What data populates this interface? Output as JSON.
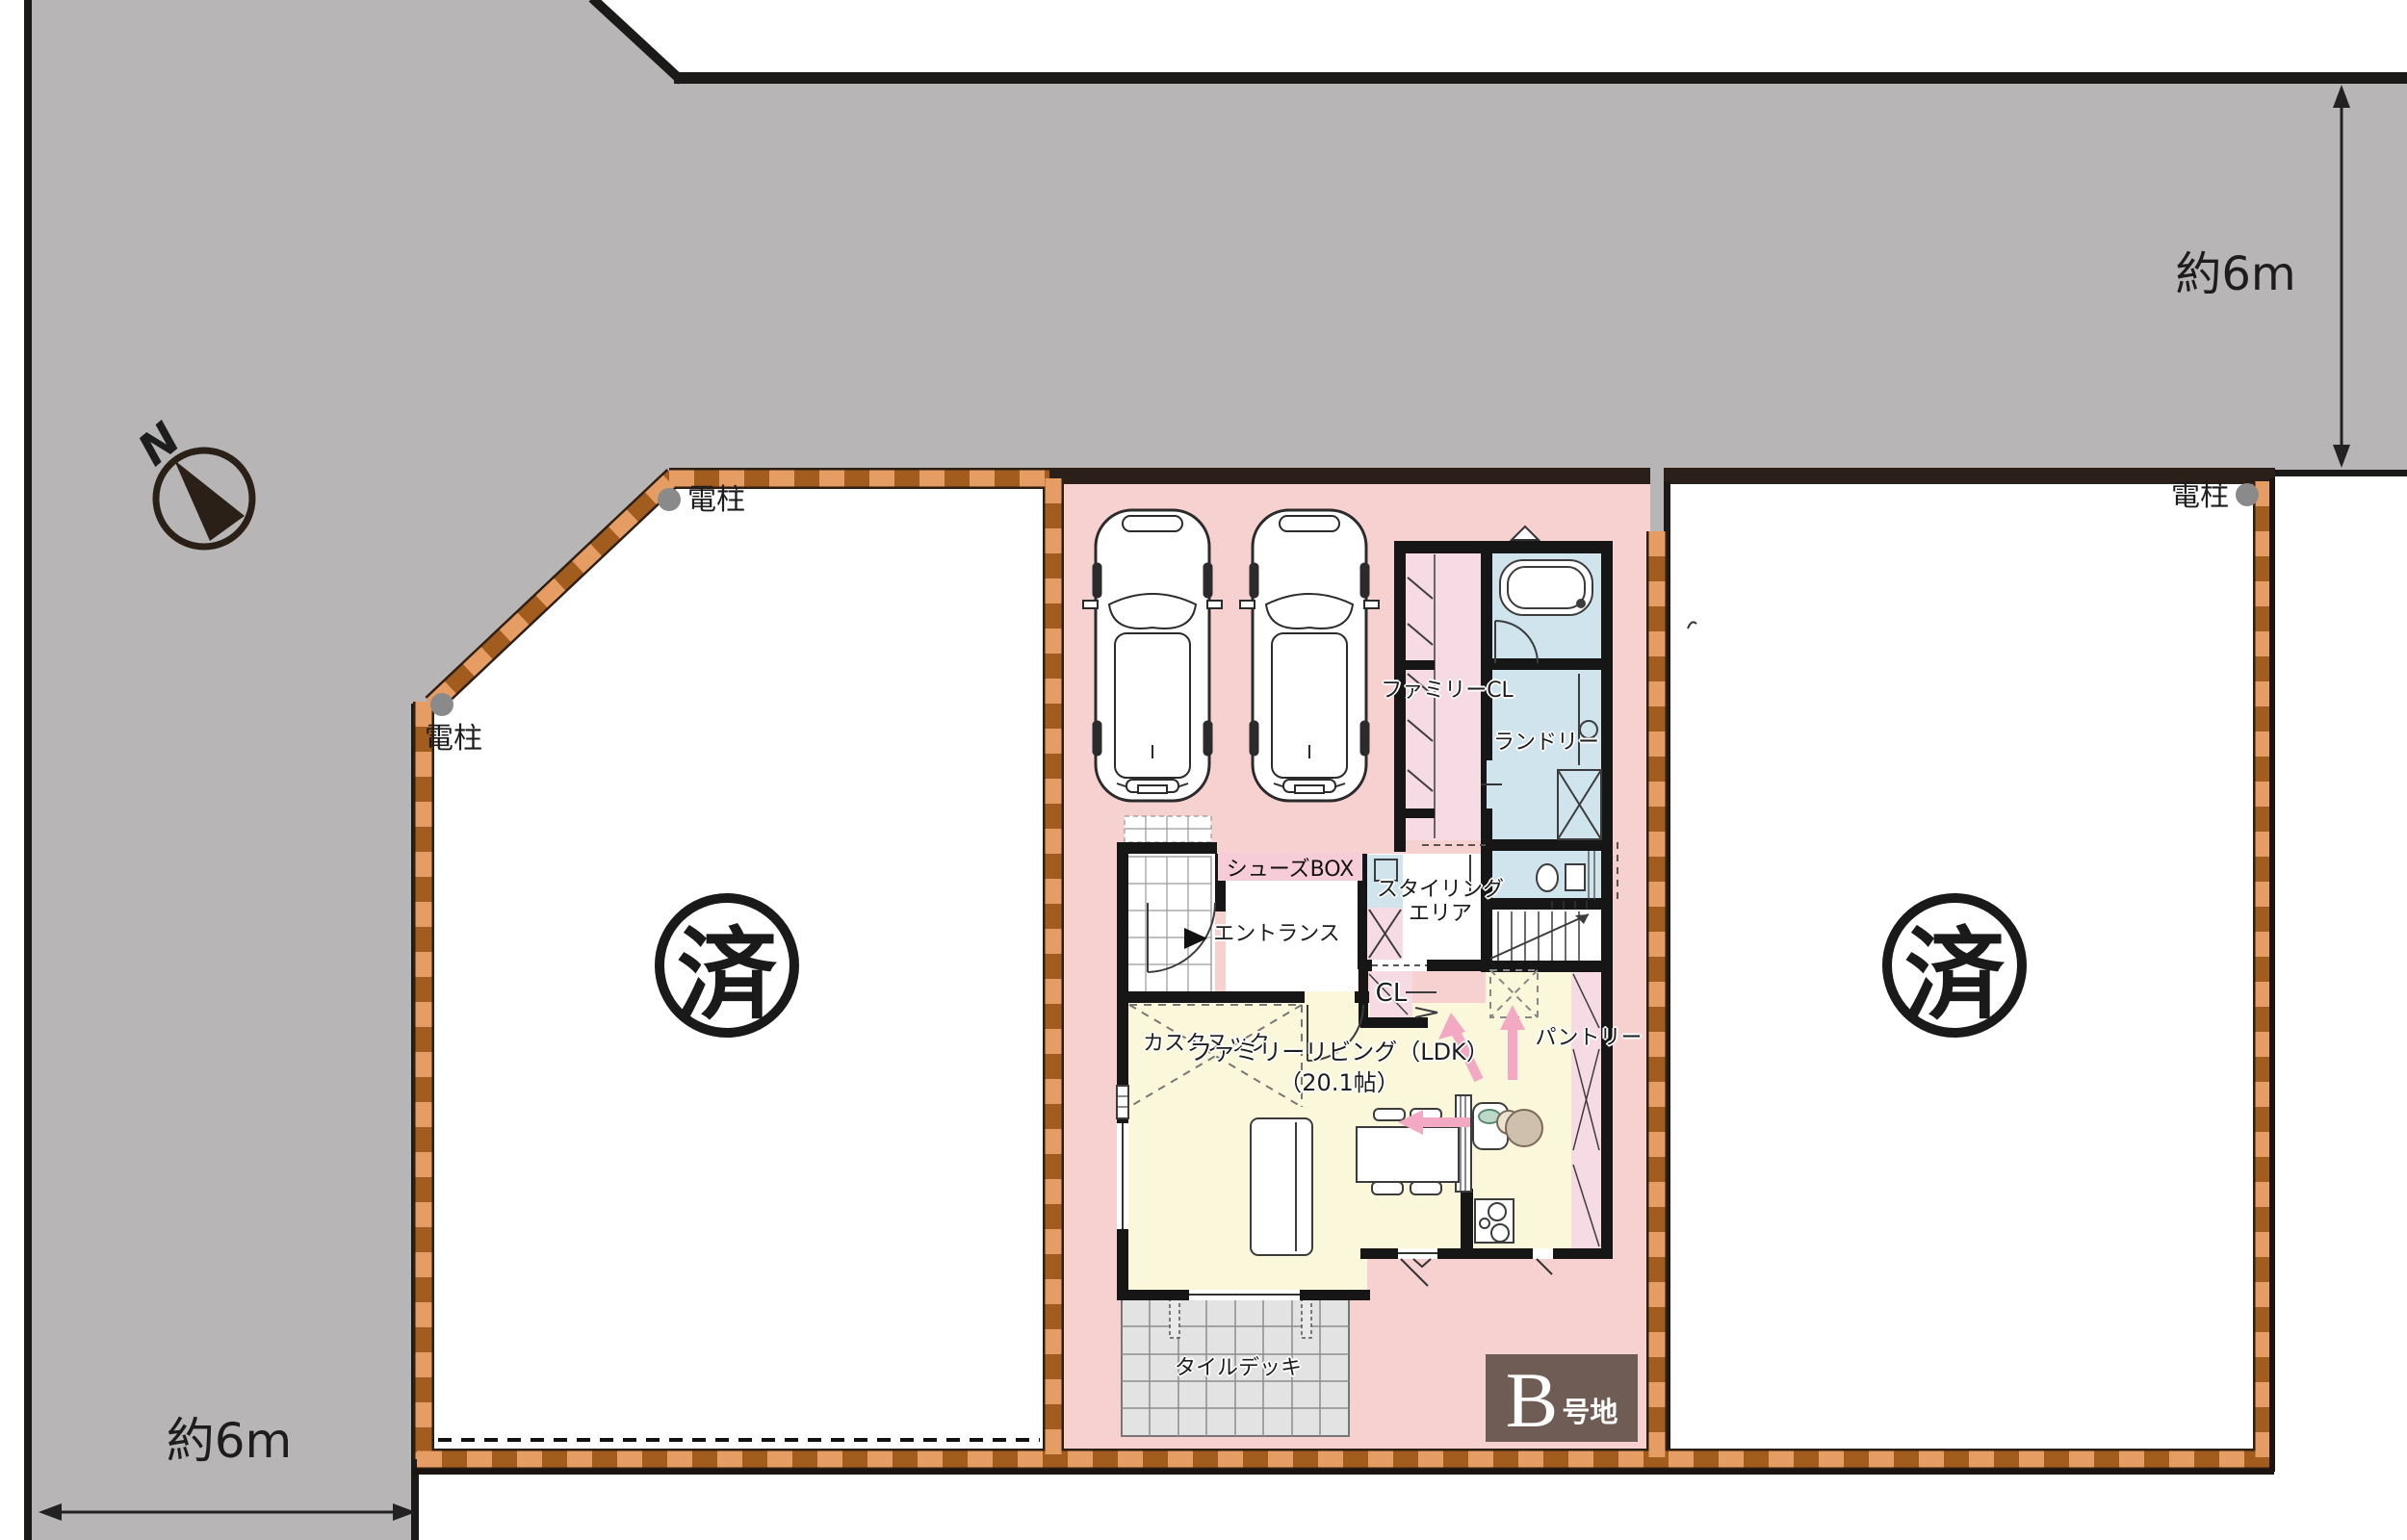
{
  "compass": {
    "north_label": "N"
  },
  "dimensions": {
    "top_right": "約6m",
    "bottom_left": "約6m"
  },
  "utility_pole": {
    "label": "電柱"
  },
  "lots": {
    "left": {
      "status": "済"
    },
    "right": {
      "status": "済"
    },
    "b": {
      "badge_letter": "B",
      "badge_suffix": "号地"
    }
  },
  "rooms": {
    "family_closet": "ファミリーCL",
    "laundry": "ランドリー",
    "shoes_box": "シューズBOX",
    "entrance": "エントランス",
    "styling_area_line1": "スタイリング",
    "styling_area_line2": "エリア",
    "custom_nook": "カスタヌック",
    "closet": "CL",
    "pantry": "パントリー",
    "family_living": "ファミリーリビング（LDK）",
    "family_living_size": "（20.1帖）",
    "tile_deck": "タイルデッキ"
  },
  "colors": {
    "road": "#b7b5b5",
    "lot_pink": "#f7d0d0",
    "boundary_light": "#e59d63",
    "boundary_dark": "#a25c1e",
    "room_blue": "#cfe4ec",
    "room_pink": "#f6dbe5",
    "ldk_yellow": "#fbf7da",
    "badge_brown": "#6f5c55",
    "arrow_pink": "#f3a8c4"
  }
}
